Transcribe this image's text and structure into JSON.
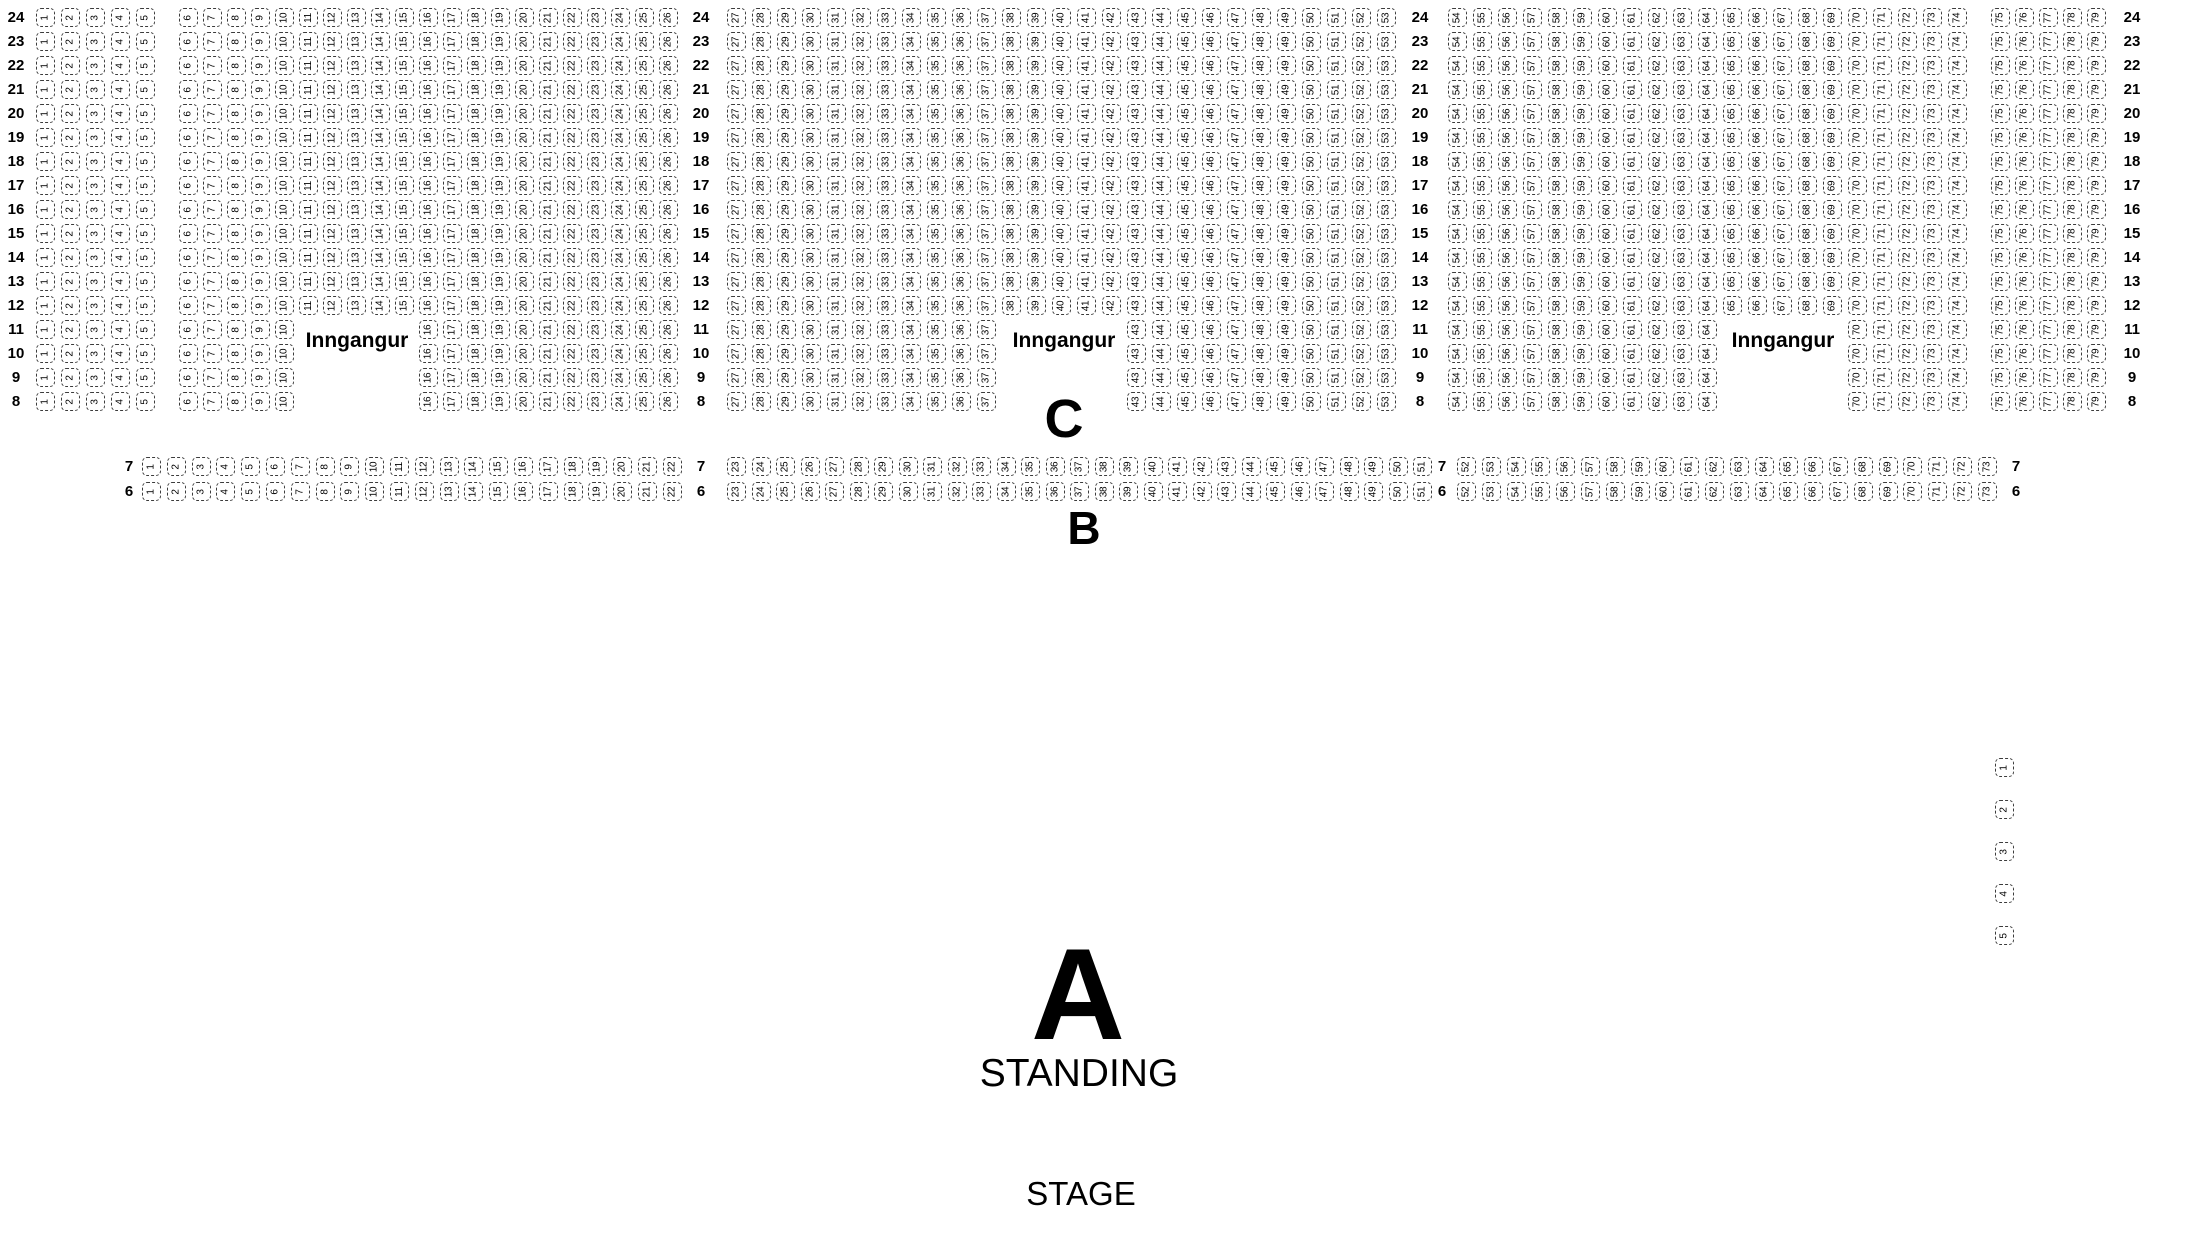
{
  "map": {
    "entrance_label": "Inngangur",
    "section_c_label": "C",
    "section_b_label": "B",
    "section_a_label": "A",
    "standing_label": "STANDING",
    "stage_label": "STAGE",
    "rear_block": {
      "row_numbers": [
        24,
        23,
        22,
        21,
        20,
        19,
        18,
        17,
        16,
        15,
        14,
        13,
        12,
        11,
        10,
        9,
        8
      ],
      "seat_start": 1,
      "seat_end": 79,
      "aisle_after_seats": [
        5,
        74
      ],
      "label_column_after_seats": [
        26,
        53
      ],
      "entrance_rows": [
        11,
        10,
        9,
        8
      ],
      "entrance_gaps": [
        {
          "from": 11,
          "to": 15
        },
        {
          "from": 38,
          "to": 42
        },
        {
          "from": 65,
          "to": 69
        }
      ]
    },
    "front_block": {
      "row_numbers": [
        7,
        6
      ],
      "seat_start": 1,
      "seat_end": 73,
      "label_column_after_seats": [
        22,
        51
      ]
    },
    "side_seats": [
      1,
      2,
      3,
      4,
      5
    ],
    "colors": {
      "background": "#ffffff",
      "text": "#000000",
      "seat_border": "#3c3c3c"
    }
  }
}
